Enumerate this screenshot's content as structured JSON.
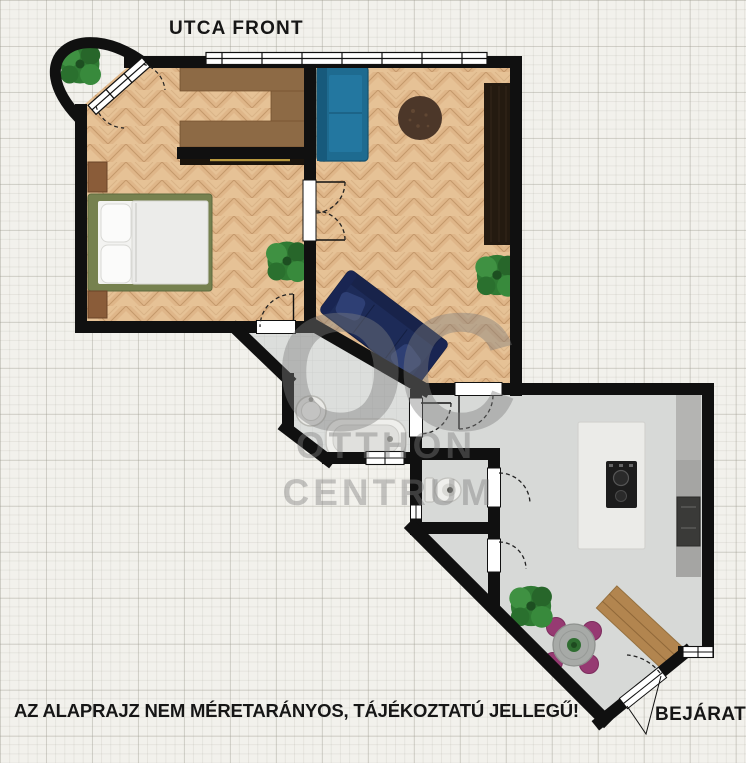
{
  "labels": {
    "street_front": "UTCA FRONT",
    "entrance": "BEJÁRAT",
    "disclaimer": "AZ ALAPRAJZ NEM MÉRETARÁNYOS, TÁJÉKOZTATÚ JELLEGŰ!"
  },
  "watermark": {
    "monogram": "OC",
    "line1": "OTTHON",
    "line2": "CENTRUM"
  },
  "colors": {
    "background": "#f2f1ec",
    "wall": "#101010",
    "parquet": "#e6c296",
    "floor_bathroom": "#dcdedc",
    "floor_kitchen": "#d7d9d7",
    "sofa_teal": "#1e6b90",
    "sofa_navy": "#1d2b58",
    "bed_frame": "#76814f",
    "wardrobe_wood": "#8d6a45",
    "nightstand_wood": "#8a5c39",
    "cabinet_dark": "#241a10",
    "rug_brown": "#4c3729",
    "sideboard_wood": "#b2854f",
    "chair_magenta": "#963a72",
    "plant_green": "#2f7a33",
    "counter_gray": "#a5a5a3",
    "island_white": "#ebebe8",
    "fixture_white": "#efefec",
    "watermark_gray": "#7e7e7e",
    "label_text": "#161616"
  },
  "fixtures": [
    "bed",
    "nightstand",
    "wardrobe",
    "teal-sofa",
    "navy-sofa",
    "round-rug",
    "tall-cabinet",
    "washbasin",
    "bathtub",
    "toilet",
    "kitchen-island",
    "cooktop",
    "counter",
    "oven",
    "dining-table",
    "dining-chair",
    "sideboard",
    "plant",
    "window",
    "door"
  ]
}
